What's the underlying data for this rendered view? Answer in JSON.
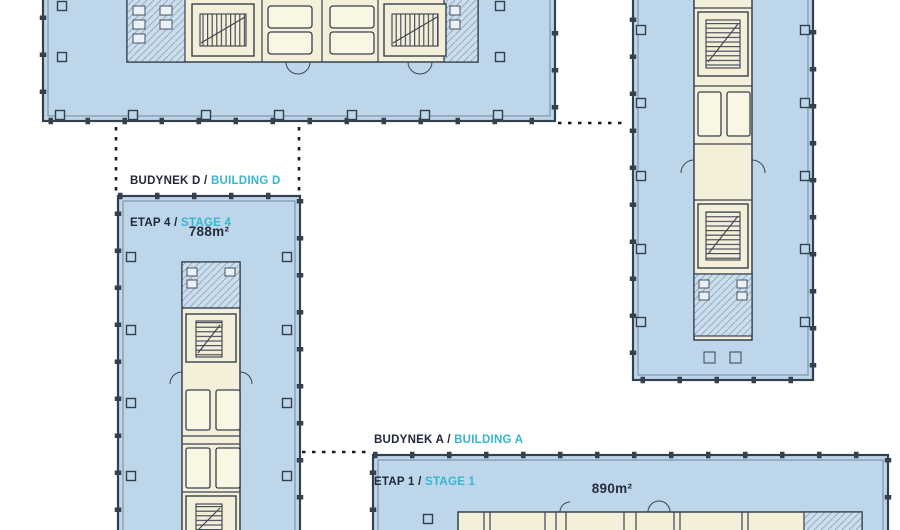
{
  "site": {
    "building_d": {
      "label_line1_pl": "BUDYNEK D / ",
      "label_line1_en": "BUILDING D",
      "label_line2_pl": "ETAP 4 / ",
      "label_line2_en": "STAGE 4",
      "area": "788m²"
    },
    "building_a": {
      "label_line1_pl": "BUDYNEK A / ",
      "label_line1_en": "BUILDING A",
      "label_line2_pl": "ETAP 1 / ",
      "label_line2_en": "STAGE 1",
      "area": "890m²"
    },
    "colors": {
      "floor_fill": "#bdd6ea",
      "core_fill": "#f4efd8",
      "toilet_fill": "#ccdeed",
      "outline": "#35404f",
      "boundary_dash": "#1b1b1b",
      "accent_cyan": "#36b7cf",
      "label_text": "#20293a"
    }
  }
}
